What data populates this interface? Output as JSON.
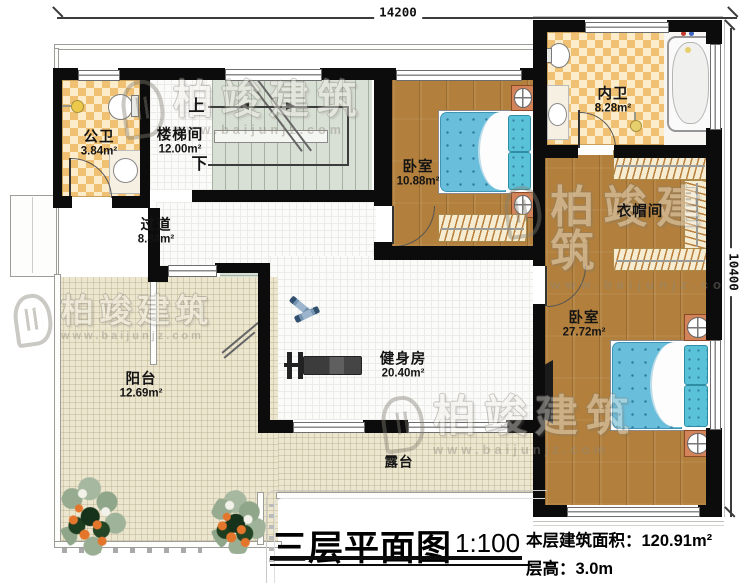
{
  "dimensions": {
    "top": "14200",
    "right": "10400"
  },
  "rooms": {
    "gongwei": {
      "name": "公卫",
      "area": "3.84m²"
    },
    "loutijian": {
      "name": "楼梯间",
      "area": "12.00m²"
    },
    "guodao": {
      "name": "过道",
      "area": "8.84m²"
    },
    "bedroom1": {
      "name": "卧室",
      "area": "10.88m²"
    },
    "neiwei": {
      "name": "内卫",
      "area": "8.28m²"
    },
    "yimaojian": {
      "name": "衣帽间"
    },
    "bedroom2": {
      "name": "卧室",
      "area": "27.72m²"
    },
    "gym": {
      "name": "健身房",
      "area": "20.40m²"
    },
    "yangtai": {
      "name": "阳台",
      "area": "12.69m²"
    },
    "lutai": {
      "name": "露台"
    }
  },
  "stairs": {
    "up": "上",
    "down": "下"
  },
  "title": {
    "text": "三层平面图",
    "scale": "1:100"
  },
  "info": {
    "area_label": "本层建筑面积：",
    "area_value": "120.91m²",
    "height_label": "层高：",
    "height_value": "3.0m"
  },
  "watermark": {
    "brand": "柏竣建筑",
    "url": "www.baijunjz.com"
  },
  "colors": {
    "wall": "#0c0c0c",
    "wood": "#b2803c",
    "bath_checker": "#f1c173",
    "stair": "#d8dfd4",
    "bed": "#69bedc",
    "terrace": "#ece6cf"
  }
}
